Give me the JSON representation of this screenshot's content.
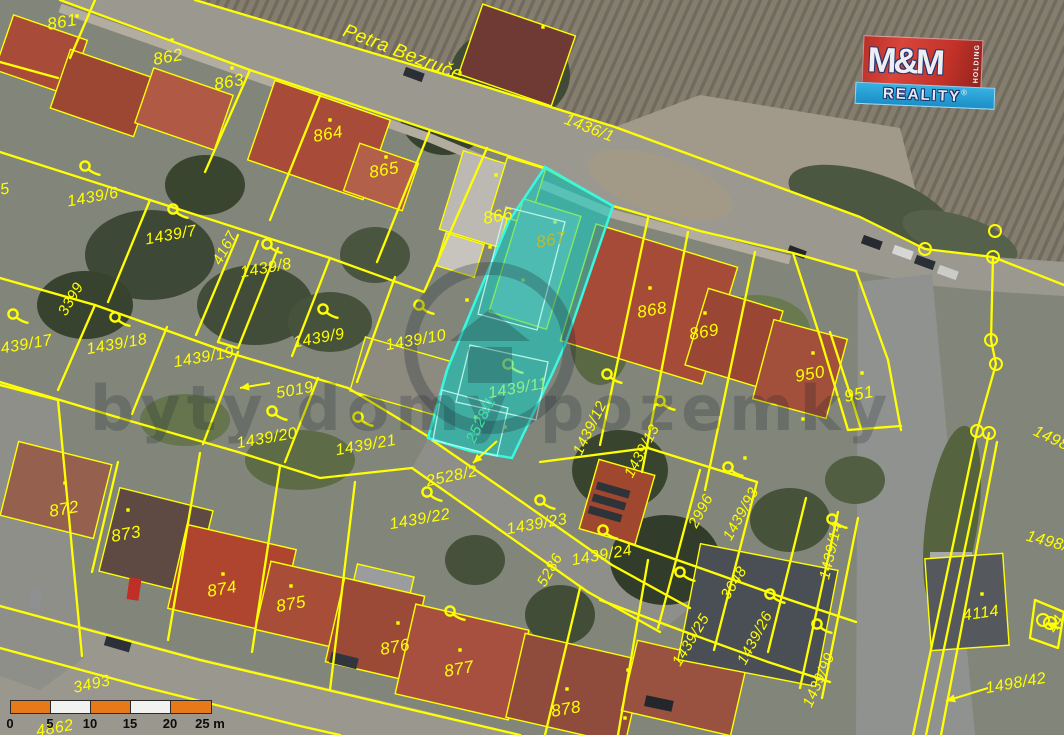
{
  "map": {
    "street_name": "Petra Bezruče",
    "highlighted_parcels": [
      "867",
      "1439/11",
      "2528/1"
    ],
    "labels": [
      {
        "t": "861",
        "x": 62,
        "y": 22,
        "r": -10,
        "s": 17
      },
      {
        "t": "862",
        "x": 168,
        "y": 57,
        "r": -10,
        "s": 17
      },
      {
        "t": "863",
        "x": 229,
        "y": 82,
        "r": -10,
        "s": 17
      },
      {
        "t": "864",
        "x": 328,
        "y": 134,
        "r": -10,
        "s": 17
      },
      {
        "t": "865",
        "x": 384,
        "y": 170,
        "r": -10,
        "s": 17
      },
      {
        "t": "866",
        "x": 498,
        "y": 216,
        "r": -10,
        "s": 17
      },
      {
        "t": "867",
        "x": 551,
        "y": 240,
        "r": -10,
        "s": 17,
        "c": "olive"
      },
      {
        "t": "868",
        "x": 652,
        "y": 310,
        "r": -10,
        "s": 17
      },
      {
        "t": "869",
        "x": 704,
        "y": 332,
        "r": -10,
        "s": 17
      },
      {
        "t": "950",
        "x": 810,
        "y": 374,
        "r": -10,
        "s": 17
      },
      {
        "t": "951",
        "x": 859,
        "y": 394,
        "r": -10,
        "s": 17
      },
      {
        "t": "872",
        "x": 64,
        "y": 509,
        "r": -10,
        "s": 17
      },
      {
        "t": "873",
        "x": 126,
        "y": 534,
        "r": -10,
        "s": 17
      },
      {
        "t": "874",
        "x": 222,
        "y": 589,
        "r": -10,
        "s": 17
      },
      {
        "t": "875",
        "x": 291,
        "y": 604,
        "r": -10,
        "s": 17
      },
      {
        "t": "876",
        "x": 395,
        "y": 647,
        "r": -10,
        "s": 17
      },
      {
        "t": "877",
        "x": 459,
        "y": 669,
        "r": -10,
        "s": 17
      },
      {
        "t": "878",
        "x": 566,
        "y": 709,
        "r": -10,
        "s": 17
      },
      {
        "t": "Petra Bezruče",
        "x": 403,
        "y": 53,
        "r": 21,
        "s": 19
      },
      {
        "t": "1436/1",
        "x": 589,
        "y": 129,
        "r": 21,
        "s": 16
      },
      {
        "t": "1439/6",
        "x": 93,
        "y": 198,
        "r": -10,
        "s": 16
      },
      {
        "t": "1439/7",
        "x": 171,
        "y": 236,
        "r": -10,
        "s": 16
      },
      {
        "t": "4167",
        "x": 225,
        "y": 248,
        "r": -62,
        "s": 15
      },
      {
        "t": "1439/8",
        "x": 266,
        "y": 269,
        "r": -10,
        "s": 16
      },
      {
        "t": "3399",
        "x": 71,
        "y": 299,
        "r": -60,
        "s": 15
      },
      {
        "t": "1439/17",
        "x": 22,
        "y": 346,
        "r": -10,
        "s": 16
      },
      {
        "t": "1439/18",
        "x": 117,
        "y": 345,
        "r": -10,
        "s": 16
      },
      {
        "t": "1439/19",
        "x": 204,
        "y": 358,
        "r": -10,
        "s": 16
      },
      {
        "t": "1439/9",
        "x": 319,
        "y": 339,
        "r": -10,
        "s": 16
      },
      {
        "t": "1439/10",
        "x": 416,
        "y": 341,
        "r": -10,
        "s": 16
      },
      {
        "t": "5019",
        "x": 295,
        "y": 391,
        "r": -10,
        "s": 16
      },
      {
        "t": "1439/20",
        "x": 267,
        "y": 439,
        "r": -10,
        "s": 16
      },
      {
        "t": "1439/21",
        "x": 366,
        "y": 446,
        "r": -10,
        "s": 16
      },
      {
        "t": "1439/11",
        "x": 518,
        "y": 389,
        "r": -10,
        "s": 16,
        "c": "green"
      },
      {
        "t": "2528/1",
        "x": 481,
        "y": 420,
        "r": -64,
        "s": 15,
        "c": "teal"
      },
      {
        "t": "1439/12",
        "x": 590,
        "y": 428,
        "r": -64,
        "s": 15
      },
      {
        "t": "1439/13",
        "x": 642,
        "y": 451,
        "r": -62,
        "s": 15
      },
      {
        "t": "2528/2",
        "x": 452,
        "y": 477,
        "r": -12,
        "s": 16
      },
      {
        "t": "1439/22",
        "x": 420,
        "y": 520,
        "r": -10,
        "s": 16
      },
      {
        "t": "1439/23",
        "x": 537,
        "y": 525,
        "r": -10,
        "s": 16
      },
      {
        "t": "1439/24",
        "x": 602,
        "y": 556,
        "r": -10,
        "s": 16
      },
      {
        "t": "5286",
        "x": 550,
        "y": 570,
        "r": -60,
        "s": 15
      },
      {
        "t": "2996",
        "x": 701,
        "y": 511,
        "r": -62,
        "s": 15
      },
      {
        "t": "1439/93",
        "x": 741,
        "y": 514,
        "r": -61,
        "s": 15
      },
      {
        "t": "3648",
        "x": 734,
        "y": 583,
        "r": -58,
        "s": 15
      },
      {
        "t": "1439/25",
        "x": 691,
        "y": 640,
        "r": -59,
        "s": 15
      },
      {
        "t": "1439/26",
        "x": 755,
        "y": 638,
        "r": -62,
        "s": 15
      },
      {
        "t": "1439/99",
        "x": 819,
        "y": 680,
        "r": -66,
        "s": 15
      },
      {
        "t": "1439/14",
        "x": 831,
        "y": 551,
        "r": -77,
        "s": 15
      },
      {
        "t": "4114",
        "x": 981,
        "y": 614,
        "r": -8,
        "s": 16
      },
      {
        "t": "1498/42",
        "x": 1016,
        "y": 684,
        "r": -10,
        "s": 16
      },
      {
        "t": "1498",
        "x": 1051,
        "y": 439,
        "r": 25,
        "s": 16
      },
      {
        "t": "1498/",
        "x": 1047,
        "y": 542,
        "r": 15,
        "s": 16
      },
      {
        "t": "44",
        "x": 1056,
        "y": 624,
        "r": -60,
        "s": 15
      },
      {
        "t": "3493",
        "x": 92,
        "y": 685,
        "r": -12,
        "s": 16
      },
      {
        "t": "4862",
        "x": 55,
        "y": 729,
        "r": -10,
        "s": 16
      },
      {
        "t": "5",
        "x": 5,
        "y": 190,
        "r": -10,
        "s": 16
      }
    ],
    "hooks": [
      {
        "x": 85,
        "y": 166
      },
      {
        "x": 173,
        "y": 209
      },
      {
        "x": 267,
        "y": 244
      },
      {
        "x": 13,
        "y": 314
      },
      {
        "x": 115,
        "y": 317
      },
      {
        "x": 323,
        "y": 309
      },
      {
        "x": 419,
        "y": 305
      },
      {
        "x": 272,
        "y": 411
      },
      {
        "x": 358,
        "y": 417
      },
      {
        "x": 427,
        "y": 492
      },
      {
        "x": 540,
        "y": 500
      },
      {
        "x": 603,
        "y": 530
      },
      {
        "x": 680,
        "y": 572
      },
      {
        "x": 770,
        "y": 594
      },
      {
        "x": 832,
        "y": 519
      },
      {
        "x": 817,
        "y": 624
      },
      {
        "x": 728,
        "y": 467
      },
      {
        "x": 450,
        "y": 611
      },
      {
        "x": 607,
        "y": 374
      },
      {
        "x": 660,
        "y": 401
      },
      {
        "x": 508,
        "y": 364,
        "c": "green"
      }
    ],
    "building_points": [
      [
        77,
        16
      ],
      [
        172,
        40
      ],
      [
        232,
        68
      ],
      [
        330,
        120
      ],
      [
        386,
        157
      ],
      [
        543,
        27
      ],
      [
        496,
        175
      ],
      [
        467,
        300
      ],
      [
        490,
        247
      ],
      [
        555,
        222,
        1
      ],
      [
        523,
        280,
        1
      ],
      [
        505,
        427,
        1
      ],
      [
        476,
        417,
        1
      ],
      [
        650,
        288
      ],
      [
        705,
        313
      ],
      [
        813,
        353
      ],
      [
        862,
        373
      ],
      [
        803,
        419
      ],
      [
        65,
        483
      ],
      [
        128,
        510
      ],
      [
        223,
        574
      ],
      [
        291,
        586
      ],
      [
        398,
        623
      ],
      [
        460,
        650
      ],
      [
        567,
        689
      ],
      [
        628,
        670
      ],
      [
        625,
        718
      ],
      [
        982,
        594
      ],
      [
        745,
        458
      ]
    ],
    "boundary_points": [
      [
        995,
        231
      ],
      [
        925,
        249
      ],
      [
        993,
        257
      ],
      [
        991,
        340
      ],
      [
        996,
        364
      ],
      [
        977,
        431
      ],
      [
        989,
        433
      ],
      [
        1043,
        620
      ],
      [
        1050,
        623
      ]
    ],
    "arrows": [
      [
        270,
        383,
        240,
        388
      ],
      [
        497,
        441,
        473,
        463
      ],
      [
        988,
        688,
        946,
        701
      ],
      [
        1062,
        629,
        1046,
        623
      ]
    ]
  },
  "watermark": {
    "text": "byty domy pozemky"
  },
  "logo": {
    "line1": "M&M",
    "holding": "HOLDING",
    "line2": "REALITY",
    "registered": "®"
  },
  "scale_bar": {
    "ticks": [
      "0",
      "5",
      "10",
      "15",
      "20",
      "25 m"
    ],
    "unit": "m",
    "segment_meters": 5
  },
  "colors": {
    "cadastral_line": "#ffff00",
    "highlight_fill": "rgba(0,213,203,0.50)",
    "highlight_stroke": "#39f8e0",
    "label_yellow": "#ffff00",
    "label_green": "#8df08a",
    "label_teal": "#44e0a6",
    "label_olive": "#b5bd35",
    "scalebar_orange": "#e87918",
    "scalebar_white": "#f2f2f0",
    "logo_red": "#cf3830",
    "logo_blue": "#2aa4da",
    "logo_navy": "#28356e"
  }
}
